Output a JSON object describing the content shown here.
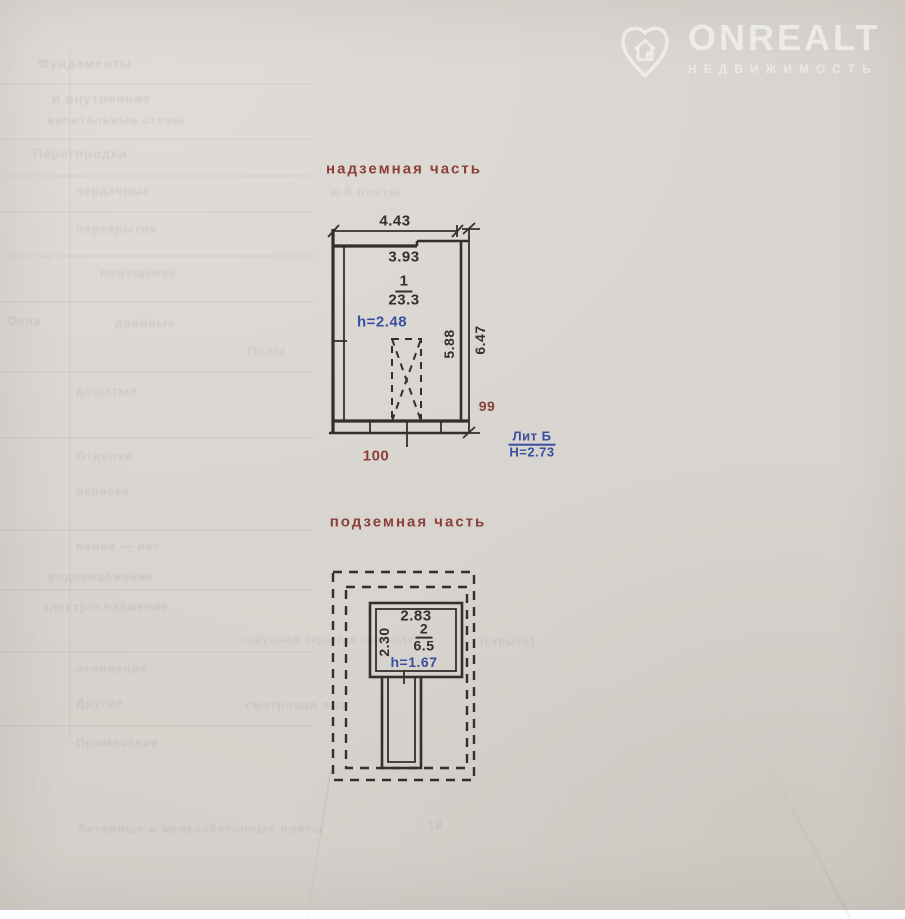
{
  "colors": {
    "paper": "#d8d4cf",
    "ink": "#32302c",
    "red": "#8a4038",
    "blue": "#3a4fa0"
  },
  "watermark": {
    "brand": "ONREALT",
    "subtitle": "НЕДВИЖИМОСТЬ"
  },
  "above_ground": {
    "title": "надземная часть",
    "dim_top": "4.43",
    "dim_inner_top": "3.93",
    "room_number": "1",
    "room_area": "23.3",
    "room_height": "h=2.48",
    "dim_inner_right": "5.88",
    "dim_outer_right": "6.47",
    "mark_right": "99",
    "mark_bottom": "100",
    "liter_label": "Лит Б",
    "liter_height": "Н=2.73"
  },
  "underground": {
    "title": "подземная часть",
    "dim_top": "2.83",
    "dim_left": "2.30",
    "room_number": "2",
    "room_area": "6.5",
    "room_height": "h=1.67"
  },
  "ghost_lines": [
    {
      "t": "Фундаменты",
      "x": 38,
      "y": 56,
      "s": 13
    },
    {
      "t": "и внутренние",
      "x": 52,
      "y": 91,
      "s": 13
    },
    {
      "t": "капитальные стены",
      "x": 48,
      "y": 113,
      "s": 12
    },
    {
      "t": "Перегородки",
      "x": 33,
      "y": 146,
      "s": 13
    },
    {
      "t": "чердачные",
      "x": 76,
      "y": 184,
      "s": 12
    },
    {
      "t": "ж-б плиты",
      "x": 330,
      "y": 185,
      "s": 12
    },
    {
      "t": "перекрытия",
      "x": 76,
      "y": 222,
      "s": 12
    },
    {
      "t": "помещение",
      "x": 100,
      "y": 266,
      "s": 12
    },
    {
      "t": "Окна",
      "x": 8,
      "y": 314,
      "s": 12
    },
    {
      "t": "двойные",
      "x": 115,
      "y": 316,
      "s": 12
    },
    {
      "t": "Полы",
      "x": 248,
      "y": 344,
      "s": 12
    },
    {
      "t": "дощатые",
      "x": 76,
      "y": 384,
      "s": 12
    },
    {
      "t": "Отделка",
      "x": 76,
      "y": 449,
      "s": 12
    },
    {
      "t": "окраска",
      "x": 76,
      "y": 484,
      "s": 12
    },
    {
      "t": "ванна — нет",
      "x": 76,
      "y": 539,
      "s": 12
    },
    {
      "t": "водоснабжение",
      "x": 48,
      "y": 570,
      "s": 12
    },
    {
      "t": "электроснабжение",
      "x": 42,
      "y": 600,
      "s": 12
    },
    {
      "t": "наружная скрытая проводка",
      "x": 240,
      "y": 634,
      "s": 11
    },
    {
      "t": "(скрыто)",
      "x": 480,
      "y": 636,
      "s": 11
    },
    {
      "t": "отопление",
      "x": 76,
      "y": 662,
      "s": 12
    },
    {
      "t": "Другие",
      "x": 76,
      "y": 696,
      "s": 12
    },
    {
      "t": "смотровая яма",
      "x": 245,
      "y": 698,
      "s": 12
    },
    {
      "t": "Примечание",
      "x": 76,
      "y": 736,
      "s": 12
    },
    {
      "t": "бетонные и железобетонные плиты",
      "x": 78,
      "y": 822,
      "s": 12
    },
    {
      "t": "18",
      "x": 428,
      "y": 818,
      "s": 12
    }
  ]
}
